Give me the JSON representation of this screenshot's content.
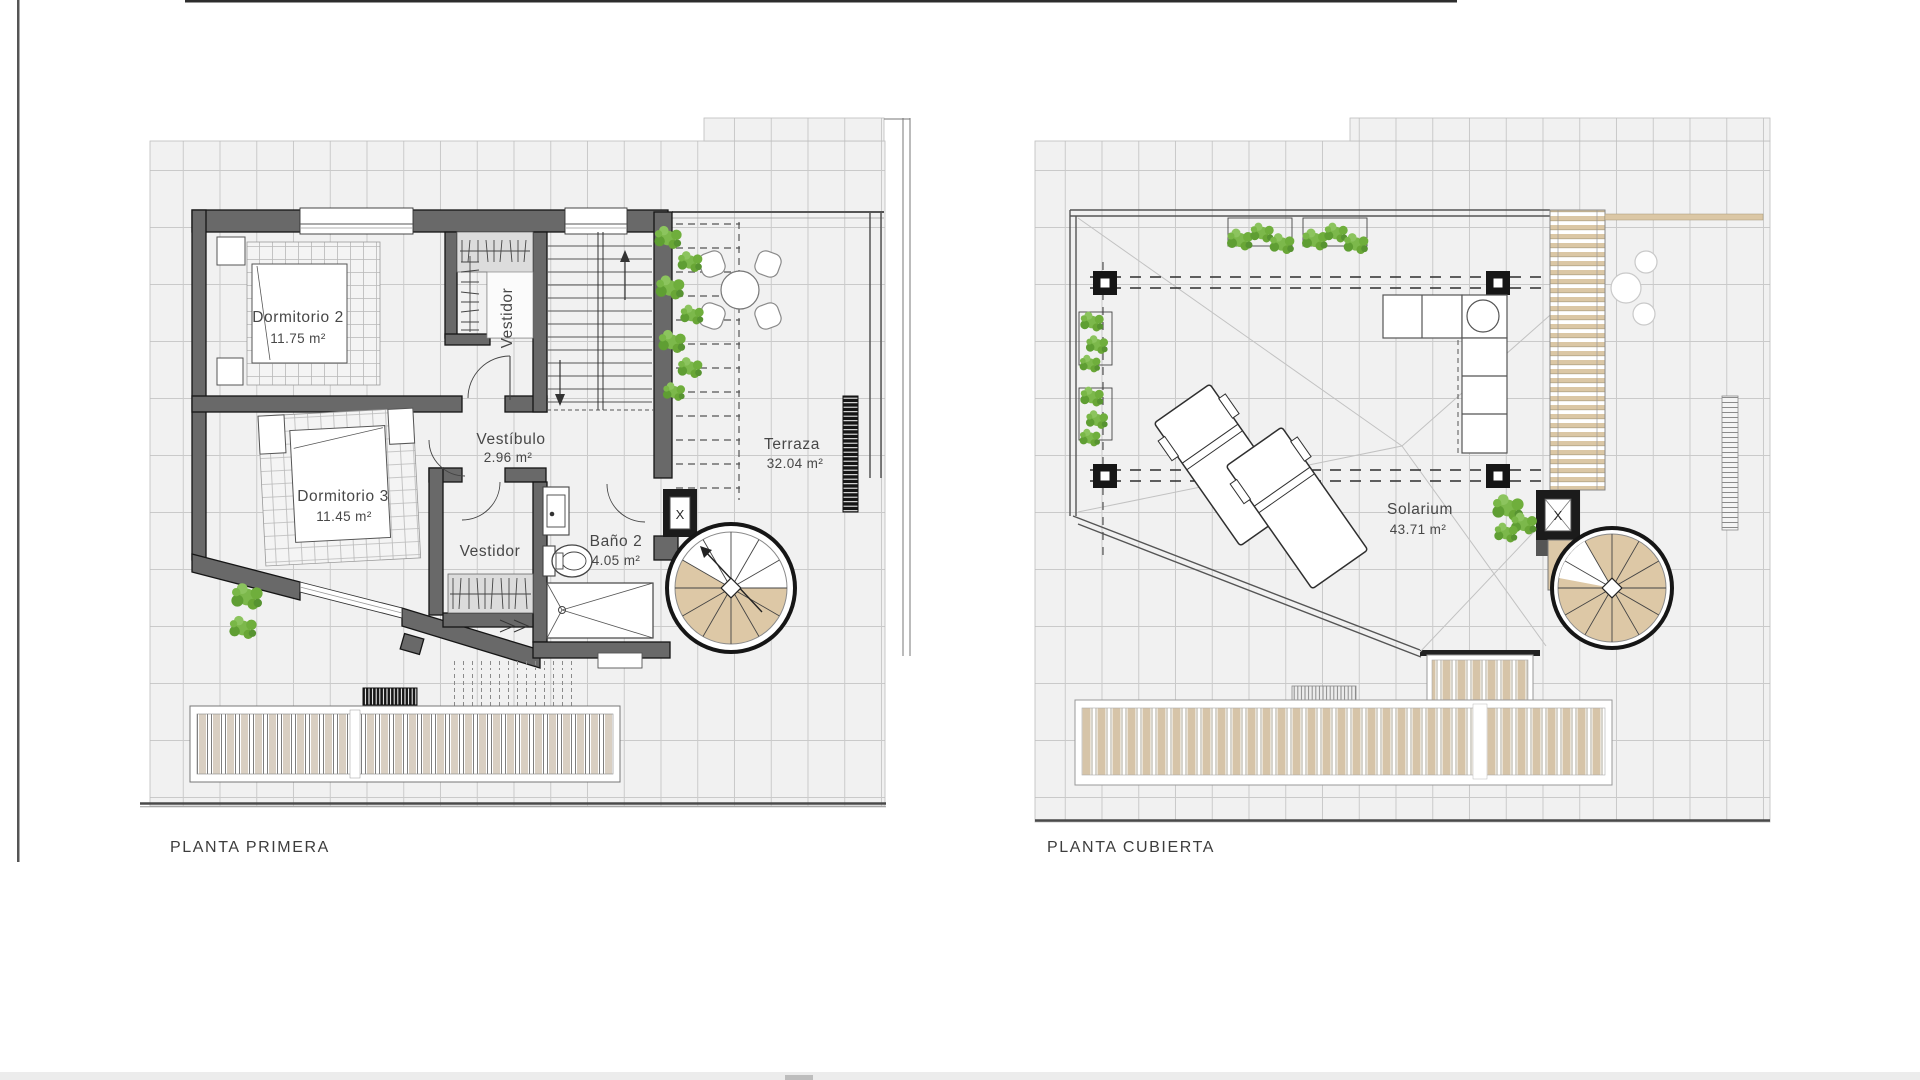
{
  "sheet": {
    "type": "architectural-floor-plans",
    "plans": [
      {
        "id": "planta-primera",
        "label": "PLANTA PRIMERA",
        "shaft_label": "X",
        "rooms": [
          {
            "name": "Dormitorio 2",
            "area": "11.75 m²"
          },
          {
            "name": "Vestidor",
            "area": ""
          },
          {
            "name": "Vestíbulo",
            "area": "2.96 m²"
          },
          {
            "name": "Dormitorio 3",
            "area": "11.45 m²"
          },
          {
            "name": "Vestidor",
            "area": ""
          },
          {
            "name": "Baño 2",
            "area": "4.05 m²"
          },
          {
            "name": "Terraza",
            "area": "32.04 m²"
          }
        ]
      },
      {
        "id": "planta-cubierta",
        "label": "PLANTA CUBIERTA",
        "shaft_label": "X",
        "rooms": [
          {
            "name": "Solarium",
            "area": "43.71 m²"
          }
        ]
      }
    ],
    "colors": {
      "wall": "#696969",
      "wall_outline": "#161616",
      "grid_fill": "#f1f1f1",
      "grid_line": "#cacaca",
      "wood": "#dbc7a5",
      "deck_stripe": "#d6c4a8",
      "foliage": "#6fae3c",
      "text": "#474747"
    }
  }
}
